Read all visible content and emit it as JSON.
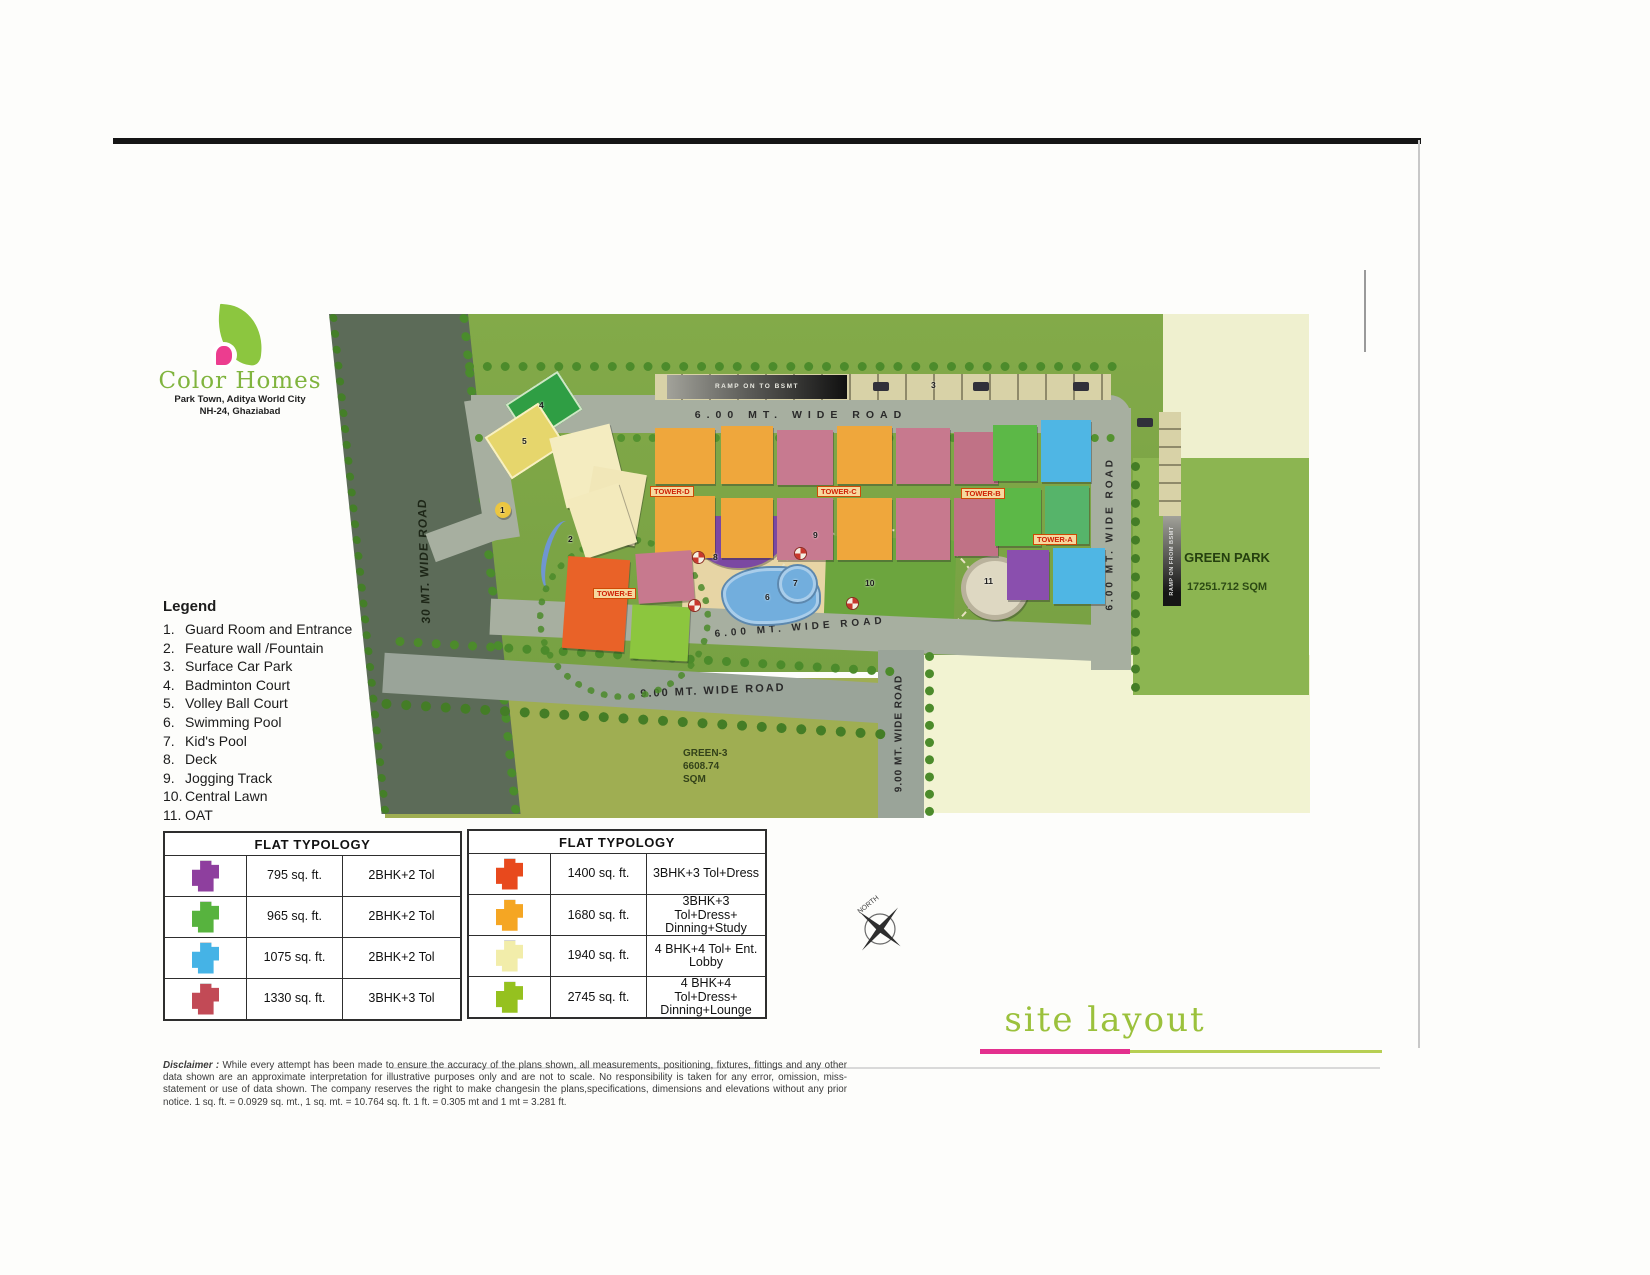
{
  "logo": {
    "title": "Color Homes",
    "subtitle1": "Park Town, Aditya World City",
    "subtitle2": "NH-24, Ghaziabad"
  },
  "legend": {
    "title": "Legend",
    "items": [
      {
        "n": "1.",
        "label": "Guard Room and Entrance"
      },
      {
        "n": "2.",
        "label": "Feature wall /Fountain"
      },
      {
        "n": "3.",
        "label": "Surface Car Park"
      },
      {
        "n": "4.",
        "label": "Badminton Court"
      },
      {
        "n": "5.",
        "label": "Volley Ball Court"
      },
      {
        "n": "6.",
        "label": "Swimming Pool"
      },
      {
        "n": "7.",
        "label": "Kid's Pool"
      },
      {
        "n": "8.",
        "label": "Deck"
      },
      {
        "n": "9.",
        "label": "Jogging Track"
      },
      {
        "n": "10.",
        "label": "Central Lawn"
      },
      {
        "n": "11.",
        "label": "OAT"
      }
    ]
  },
  "typology_tables": [
    {
      "header": "FLAT TYPOLOGY",
      "rows": [
        {
          "color": "#8e3f9e",
          "area": "795 sq. ft.",
          "type": "2BHK+2 Tol"
        },
        {
          "color": "#57b33e",
          "area": "965 sq. ft.",
          "type": "2BHK+2 Tol"
        },
        {
          "color": "#45b3e6",
          "area": "1075 sq. ft.",
          "type": "2BHK+2 Tol"
        },
        {
          "color": "#c24a56",
          "area": "1330 sq. ft.",
          "type": "3BHK+3 Tol"
        }
      ]
    },
    {
      "header": "FLAT TYPOLOGY",
      "rows": [
        {
          "color": "#e8491d",
          "area": "1400 sq. ft.",
          "type": "3BHK+3 Tol+Dress"
        },
        {
          "color": "#f5a623",
          "area": "1680 sq. ft.",
          "type": "3BHK+3 Tol+Dress+ Dinning+Study"
        },
        {
          "color": "#f2edaa",
          "area": "1940 sq. ft.",
          "type": "4 BHK+4 Tol+ Ent. Lobby"
        },
        {
          "color": "#95c11f",
          "area": "2745 sq. ft.",
          "type": "4 BHK+4 Tol+Dress+ Dinning+Lounge"
        }
      ]
    }
  ],
  "disclaimer": {
    "label": "Disclaimer :",
    "text": "While every attempt has been made to ensure the accuracy of the plans shown, all measurements, positioning, fixtures, fittings and any other data shown are an approximate interpretation for illustrative purposes only and are not to scale. No responsibility is taken for any error, omission, miss-statement or use of data shown. The company reserves the right to make changesin the plans,specifications, dimensions and elevations without any prior notice. 1 sq. ft. = 0.0929 sq. mt., 1 sq. mt. = 10.764 sq. ft. 1 ft. = 0.305 mt and 1 mt = 3.281 ft."
  },
  "siteplan": {
    "roads": {
      "left": "30 MT. WIDE ROAD",
      "top": "6.00 MT. WIDE ROAD",
      "right": "6.00 MT. WIDE ROAD",
      "middle": "6.00 MT. WIDE ROAD",
      "bottom": "9.00 MT. WIDE ROAD",
      "right_bottom": "9.00 MT. WIDE ROAD"
    },
    "ramps": {
      "top": "RAMP ON TO BSMT",
      "right": "RAMP ON FROM BSMT"
    },
    "towers": {
      "a": "TOWER-A",
      "b": "TOWER-B",
      "c": "TOWER-C",
      "d": "TOWER-D",
      "e": "TOWER-E"
    },
    "club": "CLUB",
    "green_park": {
      "name": "GREEN PARK",
      "area": "17251.712 SQM"
    },
    "green3": {
      "name": "GREEN-3",
      "area": "6608.74",
      "unit": "SQM"
    },
    "markers": [
      "1",
      "2",
      "3",
      "4",
      "5",
      "6",
      "7",
      "8",
      "9",
      "10",
      "11"
    ]
  },
  "compass": {
    "north": "NORTH"
  },
  "footer": {
    "title": "site layout"
  },
  "colors": {
    "brand_green": "#8cc63f",
    "accent_pink": "#e3308e",
    "underline_green": "#b7cf53"
  }
}
